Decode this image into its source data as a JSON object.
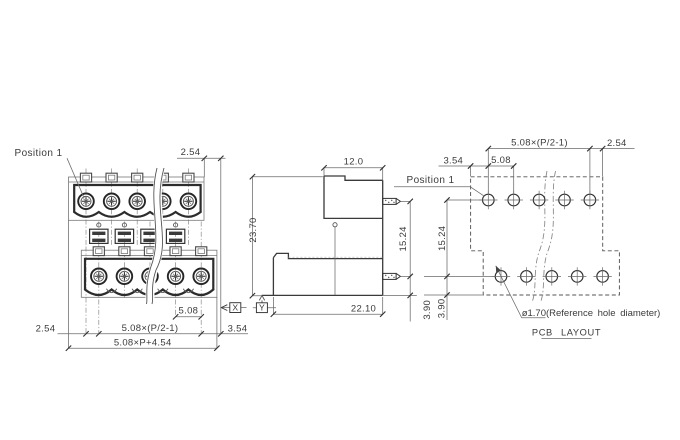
{
  "drawing": {
    "type": "terminal-block-connector-technical-drawing",
    "colors": {
      "background": "#ffffff",
      "line": "#3a3a3a",
      "dim_line": "#6a6a6a",
      "text": "#3b3b3b"
    },
    "front": {
      "position_label": "Position 1",
      "dim_top_right": "2.54",
      "dim_pitch": "5.08",
      "dim_left_offset": "2.54",
      "dim_span": "5.08×(P/2-1)",
      "dim_right_margin": "3.54",
      "dim_overall": "5.08×P+4.54",
      "detail_x": "X"
    },
    "side": {
      "dim_top_width": "12.0",
      "dim_height": "23.70",
      "dim_pin_span": "15.24",
      "dim_pin_to_edge": "3.90",
      "dim_depth": "22.10",
      "detail_y": "Y"
    },
    "pcb": {
      "position_label": "Position 1",
      "dim_span": "5.08×(P/2-1)",
      "dim_stagger": "2.54",
      "dim_left_margin": "3.54",
      "dim_pitch": "5.08",
      "dim_row_span": "15.24",
      "dim_edge": "3.90",
      "hole_note": "ø1.70(Reference hole diameter)",
      "title": "PCB LAYOUT"
    }
  }
}
